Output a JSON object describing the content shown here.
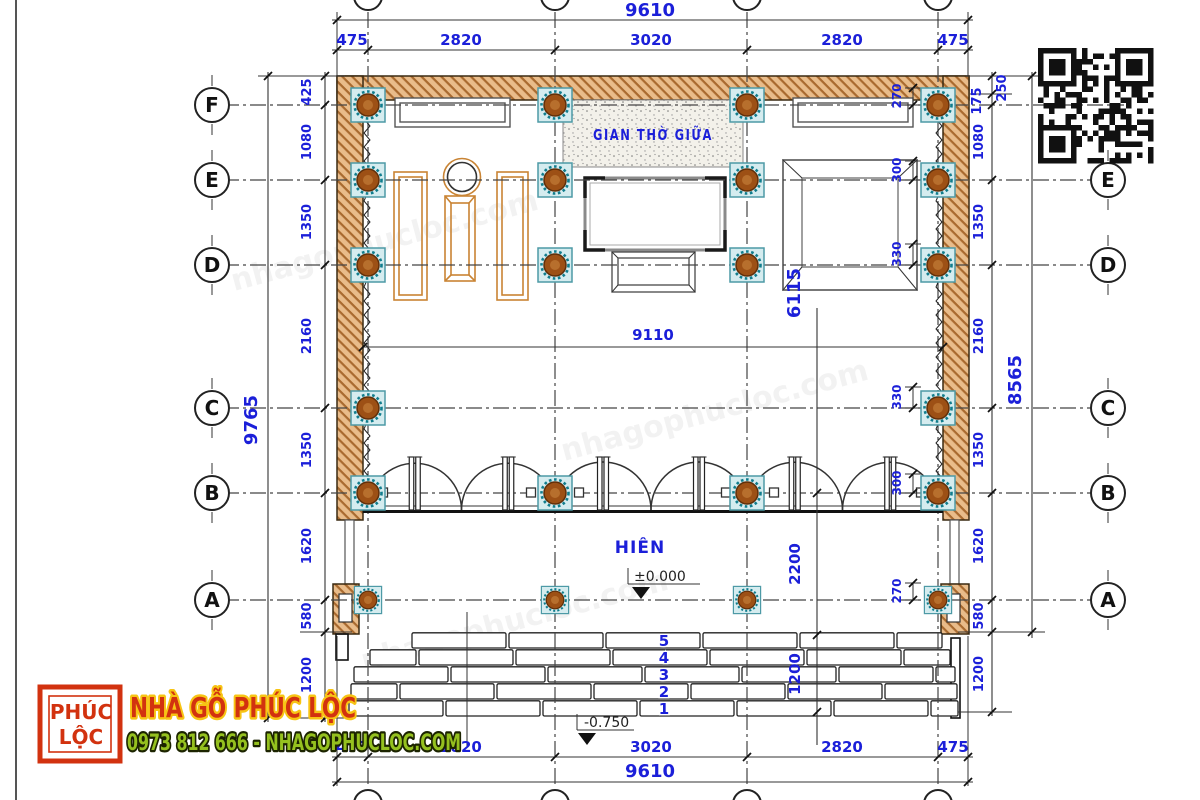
{
  "drawing": {
    "grid_rows": [
      "F",
      "E",
      "D",
      "C",
      "B",
      "A"
    ],
    "room_labels": {
      "altar_room": "GIAN THỜ GIỮA",
      "porch": "HIÊN"
    },
    "levels": {
      "zero": "±0.000",
      "minus": "-0.750"
    },
    "step_numbers": [
      "5",
      "4",
      "3",
      "2",
      "1"
    ],
    "dims": {
      "top": {
        "total": "9610",
        "segments": [
          "475",
          "2820",
          "3020",
          "2820",
          "475"
        ]
      },
      "bottom": {
        "total": "9610",
        "segments": [
          "475",
          "2820",
          "3020",
          "2820",
          "475"
        ]
      },
      "left": {
        "total": "9765",
        "segments": [
          "425",
          "1080",
          "1350",
          "2160",
          "1350",
          "1620",
          "580",
          "1200"
        ]
      },
      "right": {
        "total": "8565",
        "segments": [
          "250",
          "175",
          "1080",
          "1350",
          "2160",
          "1350",
          "1620",
          "580"
        ],
        "steps": "1200"
      },
      "inner_width": "9110",
      "center_chain": {
        "upper": "6115",
        "porch": "2200",
        "steps": "1200"
      },
      "column_offsets": {
        "F": "270",
        "E": "300",
        "D": "330",
        "C": "330",
        "B": "300",
        "A": "270"
      }
    }
  },
  "branding": {
    "logo_top": "PHÚC",
    "logo_bottom": "LỘC",
    "title": "NHÀ GỖ PHÚC LỘC",
    "contact": "0973 812 666 - NHAGOPHUCLOC.COM"
  },
  "watermark": "nhagophucloc.com",
  "colors": {
    "dim": "#1b1fd9",
    "line": "#333333",
    "wall_fill": "#e9bc8a",
    "wall_hatch": "#a96a2f",
    "column_fill": "#9d5015",
    "column_ring": "#117d8d",
    "column_box": "#d5ecef",
    "furniture": "#c98434",
    "logo_red": "#d2320f",
    "logo_yellow": "#f7c414",
    "contact_green": "#95c11f"
  }
}
